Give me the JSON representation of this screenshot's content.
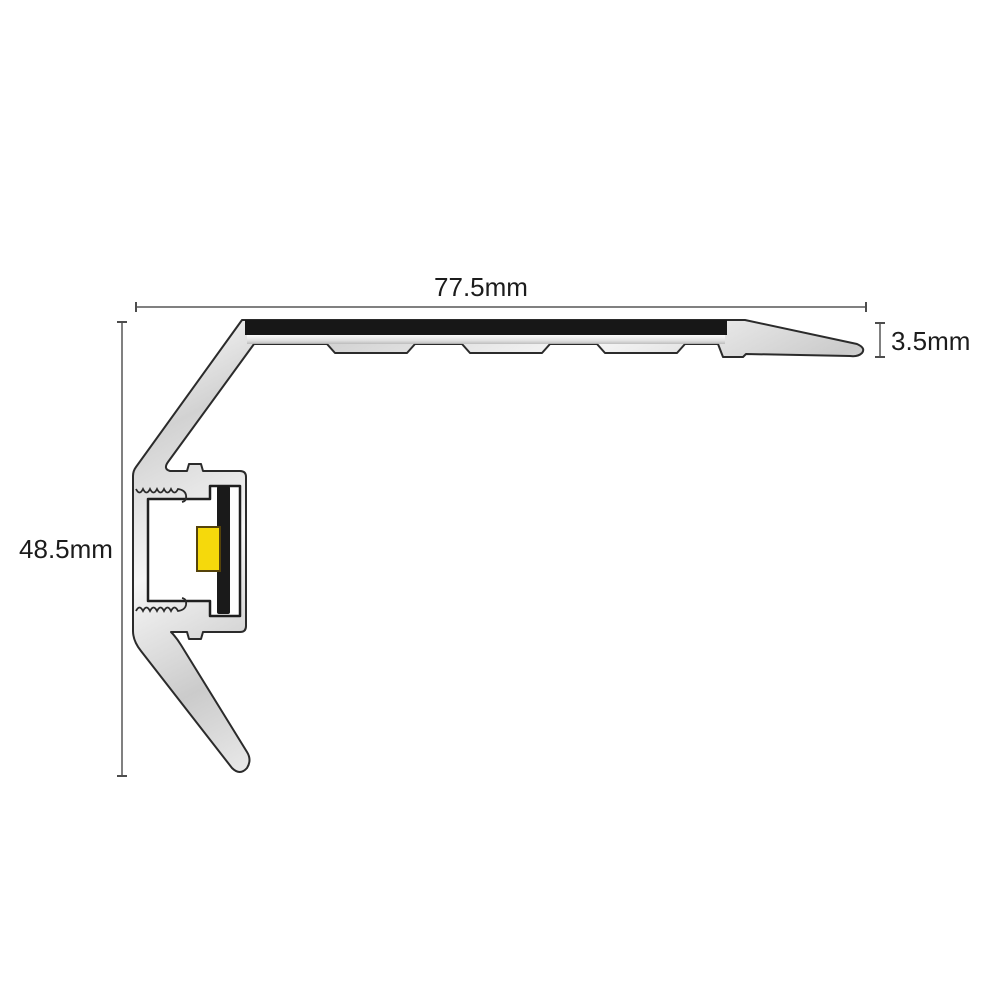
{
  "diagram": {
    "type": "technical-cross-section-drawing",
    "subject": "aluminium stair nosing profile with anti-slip insert and LED channel",
    "dimensions": {
      "width": {
        "label": "77.5mm"
      },
      "height": {
        "label": "48.5mm"
      },
      "thickness": {
        "label": "3.5mm"
      }
    },
    "colors": {
      "background": "#ffffff",
      "aluminium_light": "#f7f7f7",
      "aluminium_mid": "#d4d4d4",
      "outline": "#2b2b2b",
      "insert_black": "#171717",
      "pcb_black": "#1a1a1a",
      "led_yellow": "#f5d90c",
      "dimension_line": "#808080",
      "label_text": "#1c1c1c"
    }
  }
}
